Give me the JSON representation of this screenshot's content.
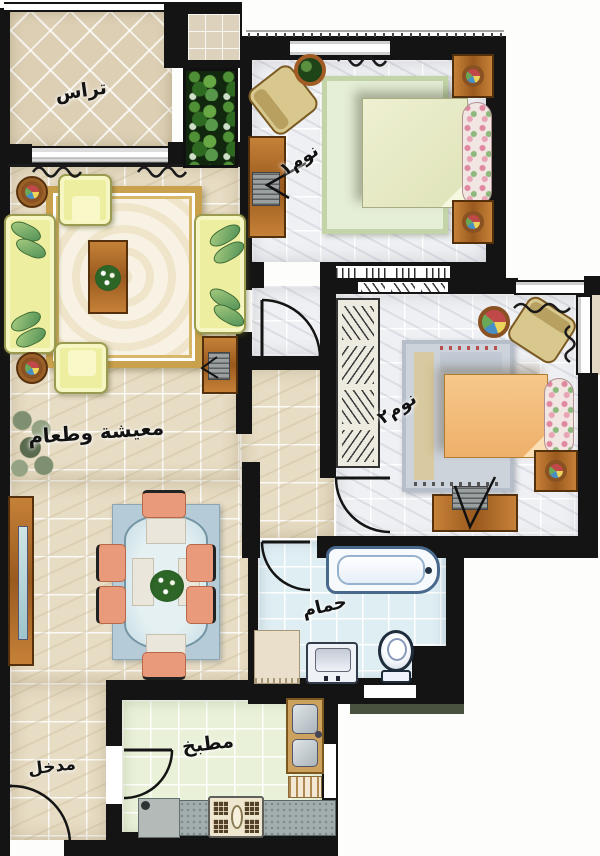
{
  "plan_type": "apartment floor plan, top-down rendered view",
  "labels_language": "Arabic",
  "rooms": {
    "terrace": {
      "label": "تراس"
    },
    "bedroom1": {
      "label": "نوم١"
    },
    "living_dining": {
      "label": "معيشة وطعام"
    },
    "bedroom2": {
      "label": "نوم٢"
    },
    "bathroom": {
      "label": "حمام"
    },
    "kitchen": {
      "label": "مطبخ"
    },
    "entrance": {
      "label": "مدخل"
    }
  },
  "palette": {
    "wall_black": "#141414",
    "floor_beige_marble": "#e7dcc4",
    "floor_white_marble": "#eff0f3",
    "floor_bath_blue": "#dfeef3",
    "floor_kitchen_green": "#e9f1d8",
    "terrace_tile": "#dccfb4",
    "sofa_yellow": "#eeeea0",
    "wood_brown": "#b06a28",
    "bed1_cream": "#e6e9c9",
    "bed2_orange": "#f2bc7c",
    "dining_chair_salmon": "#e89a7a",
    "rug_gold_border": "#c9a14c",
    "dining_glass_blue": "#cfe2ea",
    "foliage_green": "#3f7a2d"
  }
}
